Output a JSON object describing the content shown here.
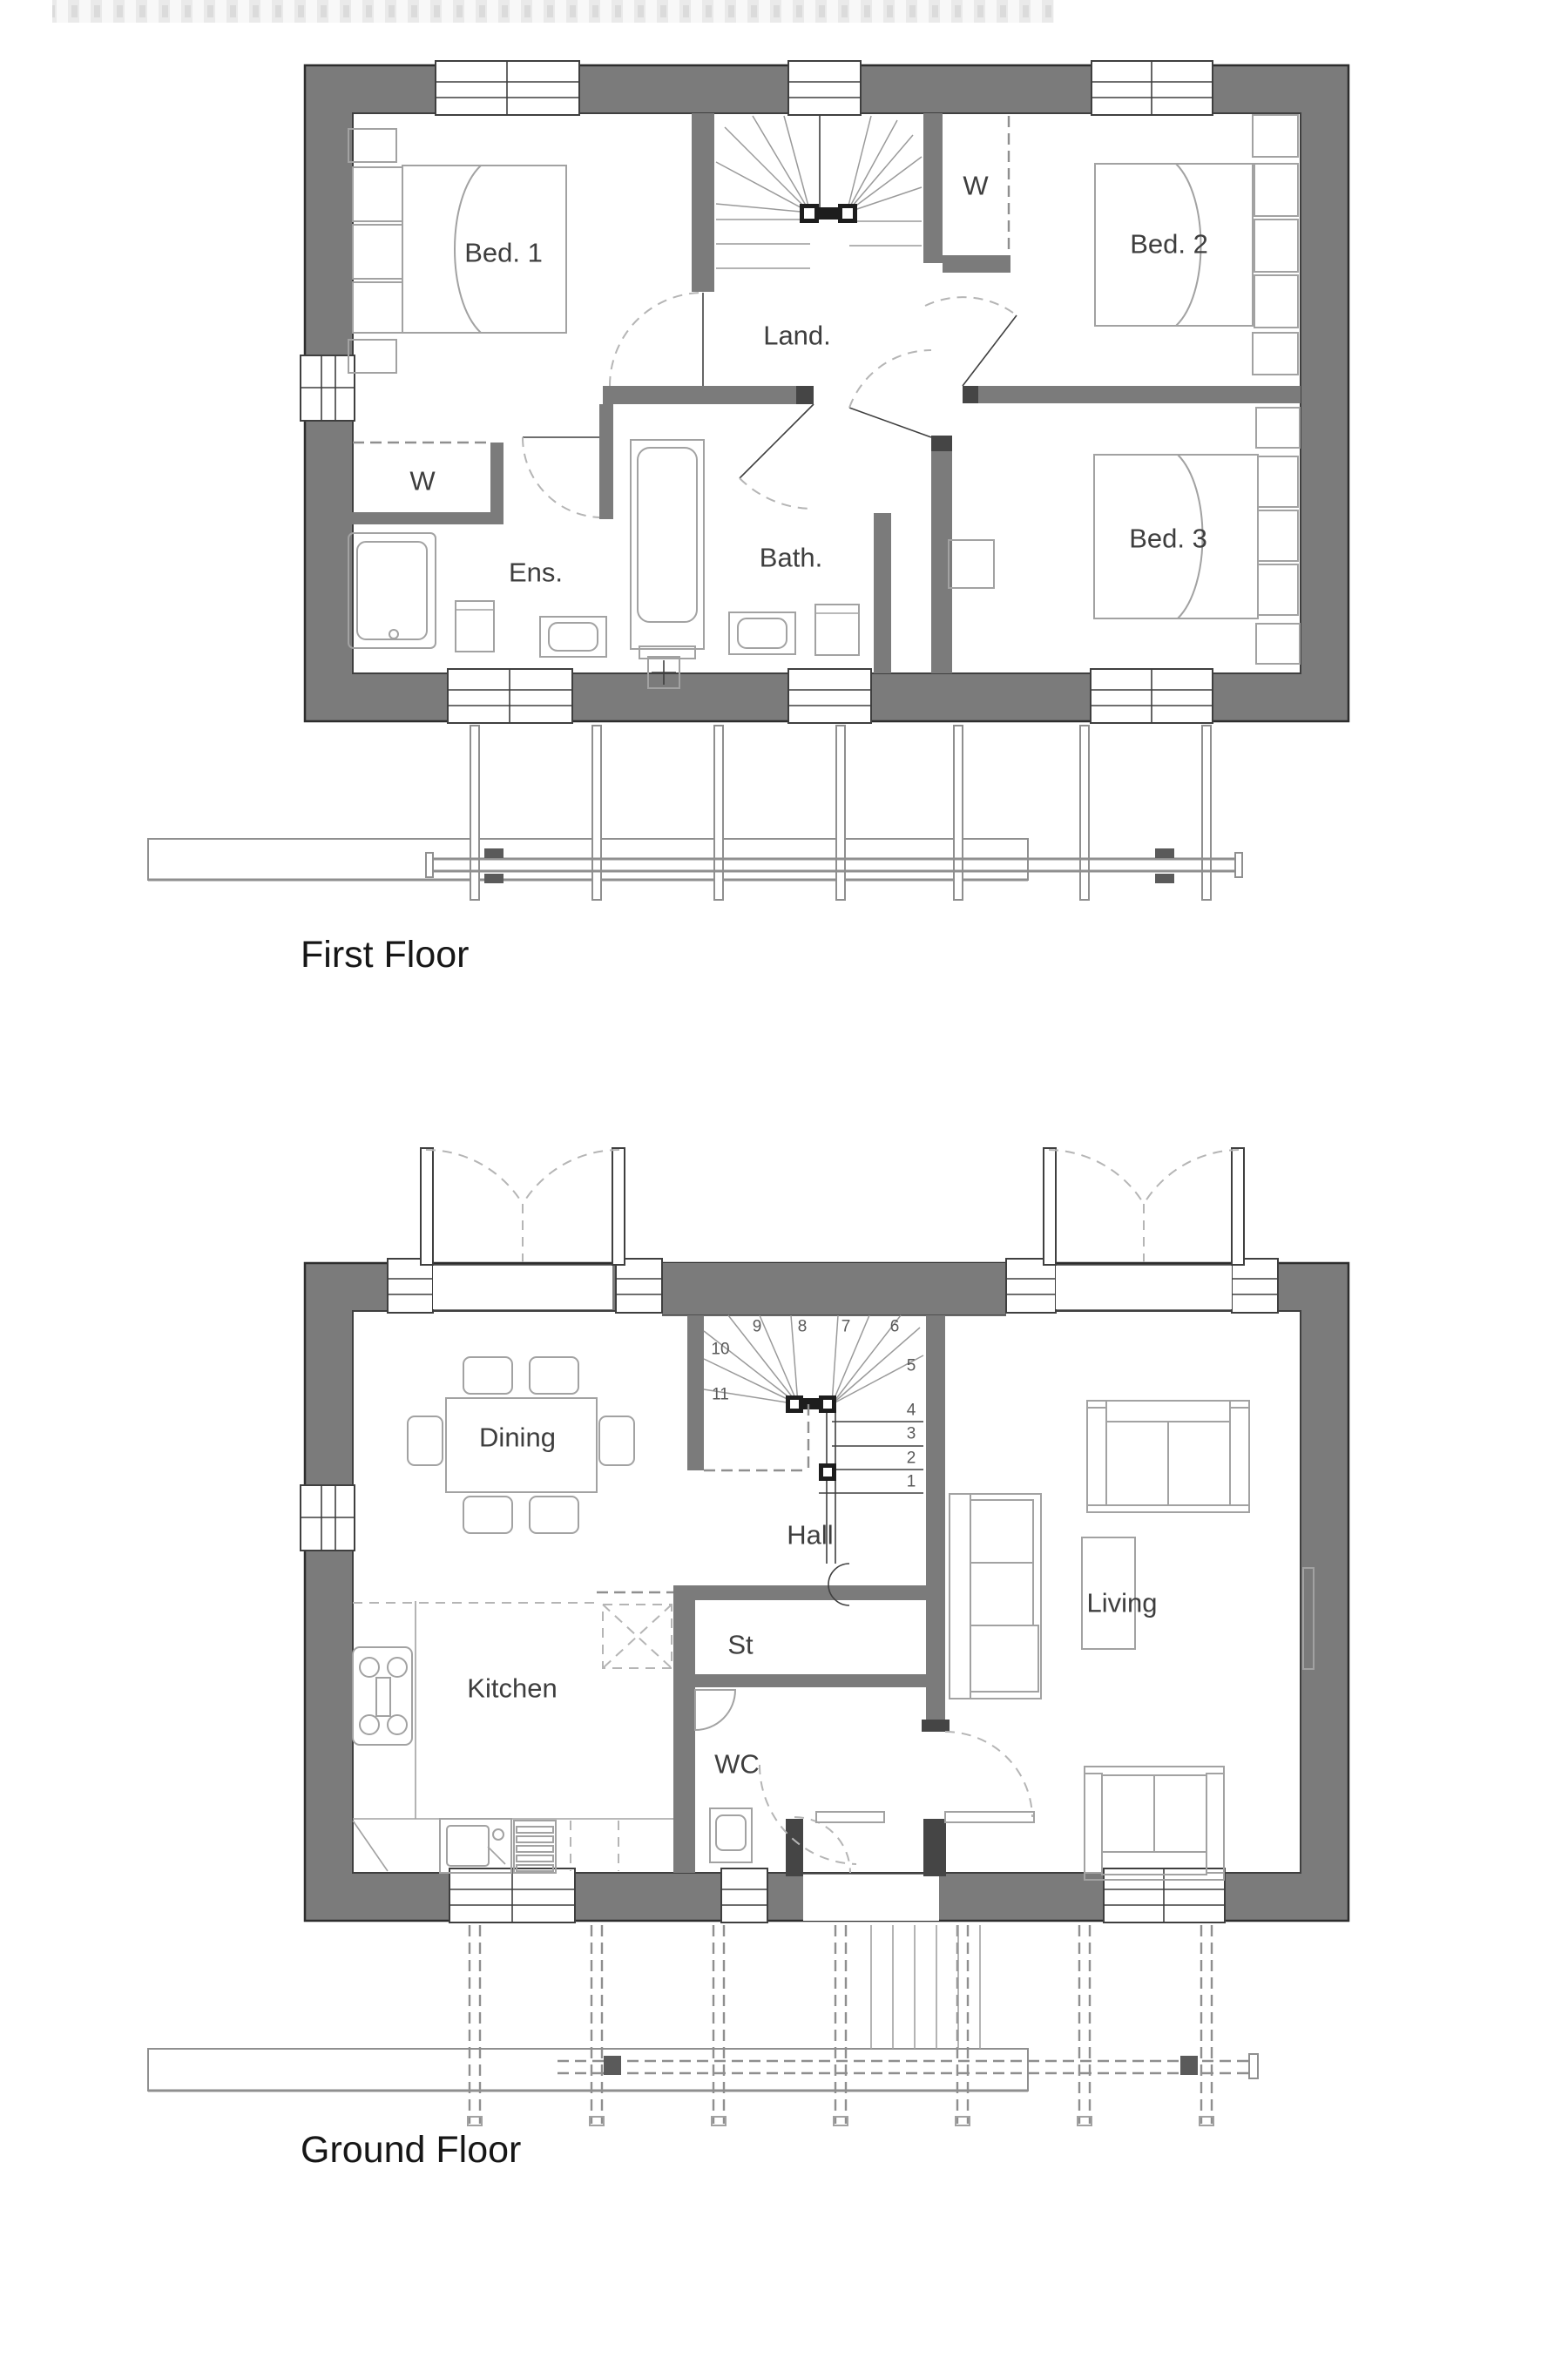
{
  "colors": {
    "wall": "#7b7b7b",
    "wall_dark": "#454545",
    "edge": "#2d2d2d",
    "line": "#3f3f3f",
    "fixture": "#a2a2a2",
    "dash": "#b5b5b5",
    "text": "#3e3e3e",
    "title": "#161616",
    "black": "#1d1d1d"
  },
  "first_floor": {
    "title": "First Floor",
    "labels": {
      "bed1": "Bed. 1",
      "bed2": "Bed. 2",
      "bed3": "Bed. 3",
      "landing": "Land.",
      "bath": "Bath.",
      "ensuite": "Ens.",
      "wardrobe1": "W",
      "wardrobe2": "W"
    }
  },
  "ground_floor": {
    "title": "Ground Floor",
    "labels": {
      "dining": "Dining",
      "kitchen": "Kitchen",
      "hall": "Hall",
      "store": "St",
      "wc": "WC",
      "living": "Living"
    },
    "stair_numbers": [
      "1",
      "2",
      "3",
      "4",
      "5",
      "6",
      "7",
      "8",
      "9",
      "10",
      "11"
    ]
  }
}
